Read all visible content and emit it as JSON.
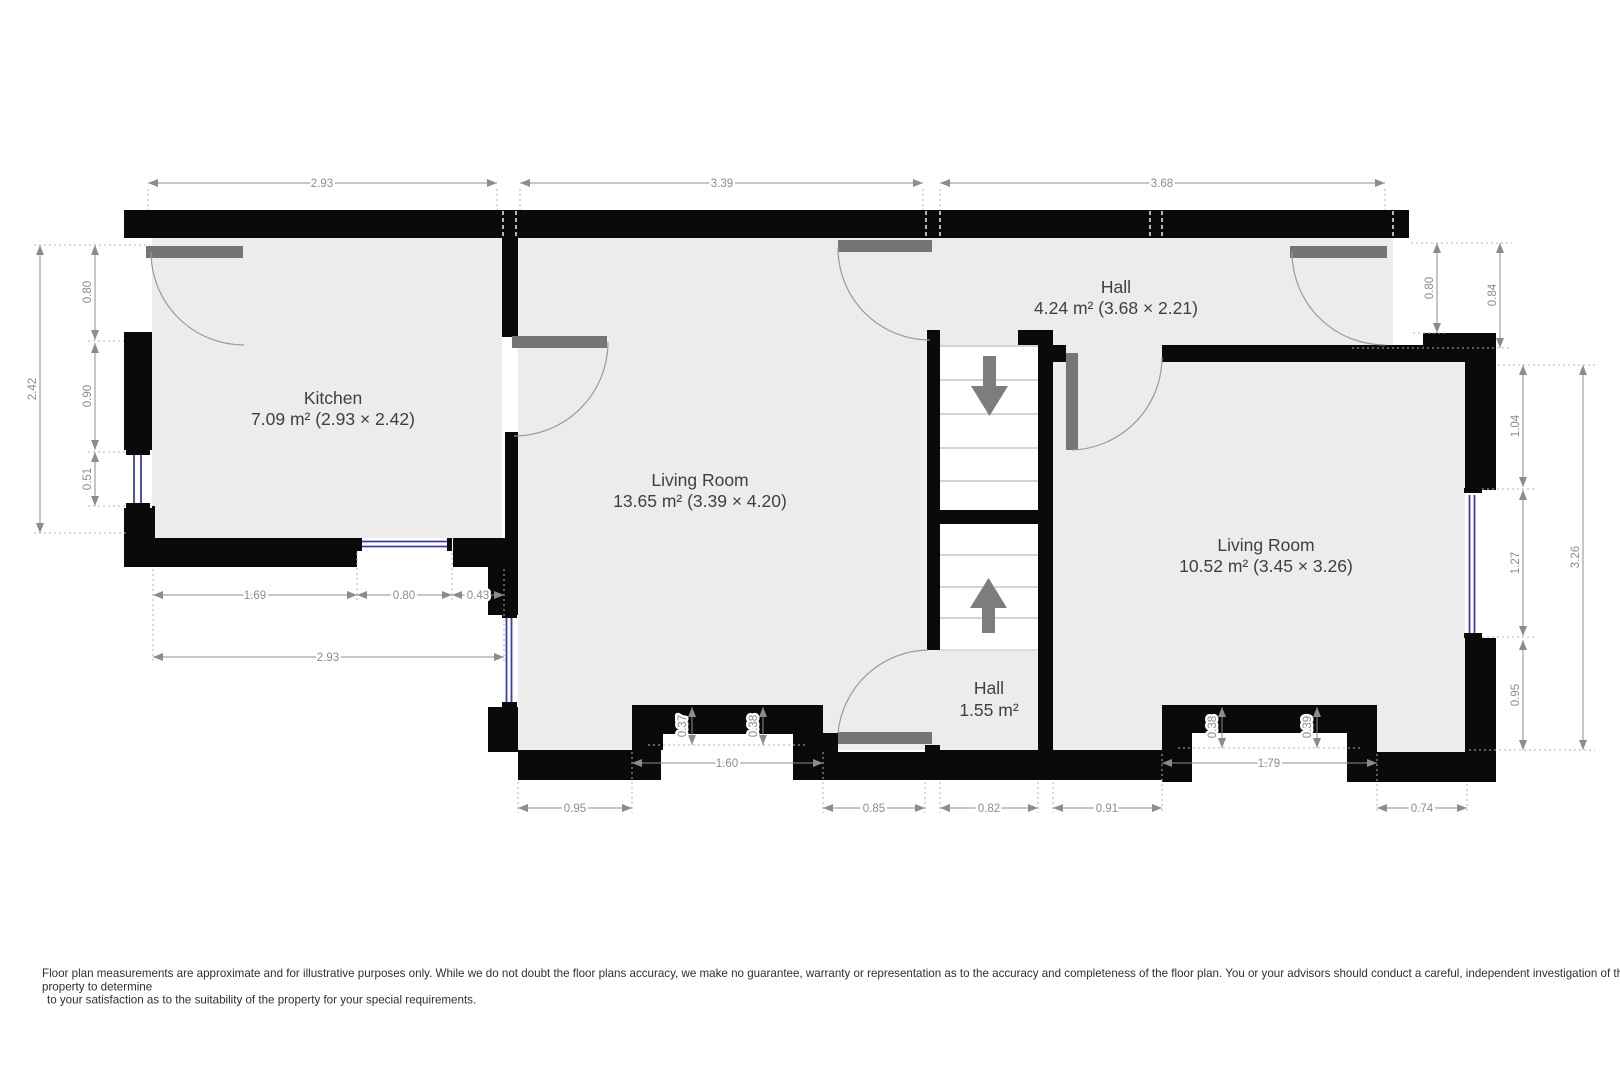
{
  "title": "Floor plan",
  "rooms": {
    "kitchen": {
      "name": "Kitchen",
      "area": "7.09 m² (2.93 × 2.42)"
    },
    "living_left": {
      "name": "Living Room",
      "area": "13.65 m² (3.39 × 4.20)"
    },
    "hall_top": {
      "name": "Hall",
      "area": "4.24 m² (3.68 × 2.21)"
    },
    "living_right": {
      "name": "Living Room",
      "area": "10.52 m² (3.45 × 3.26)"
    },
    "hall_bottom": {
      "name": "Hall",
      "area": "1.55 m²"
    }
  },
  "dim_labels": {
    "top_kitchen": "2.93",
    "top_living": "3.39",
    "top_hall": "3.68",
    "left_total": "2.42",
    "left_door": "0.80",
    "left_wall": "0.90",
    "left_window": "0.51",
    "right_door": "0.80",
    "right_offset": "0.84",
    "right_upper": "1.04",
    "right_window": "1.27",
    "right_lower": "0.95",
    "right_total": "3.26",
    "kitchen_bottom_wall": "1.69",
    "kitchen_bottom_window": "0.80",
    "kitchen_bottom_right": "0.43",
    "kitchen_bottom_total": "2.93",
    "bottom_lr_left": "0.95",
    "bottom_lr_recess": "1.60",
    "bottom_door_left": "0.85",
    "bottom_hall": "0.82",
    "bottom_right_strip": "0.91",
    "bottom_rlr_recess": "1.79",
    "bottom_rlr_right": "0.74",
    "lr_recess_d1": "0.37",
    "lr_recess_d2": "0.38",
    "rlr_recess_d1": "0.38",
    "rlr_recess_d2": "0.39"
  },
  "icons": {
    "stairs_down_arrow": "stairs-down",
    "stairs_up_arrow": "stairs-up"
  },
  "colors": {
    "wall": "#0a0a0a",
    "floor": "#ececec",
    "door_leaf": "#757575",
    "window_glass": "#3c3cae",
    "dimension": "#8c8c8c",
    "room_label": "#3f3f3f"
  },
  "disclaimer": {
    "line1": "Floor plan measurements are approximate and for illustrative purposes only. While we do not doubt the floor plans accuracy, we make no guarantee, warranty or representation as to the accuracy and completeness of the floor plan. You or your advisors should conduct a careful, independent investigation of the",
    "line2": "property to determine",
    "line3": "to your satisfaction as to the suitability of the property for your special requirements."
  }
}
